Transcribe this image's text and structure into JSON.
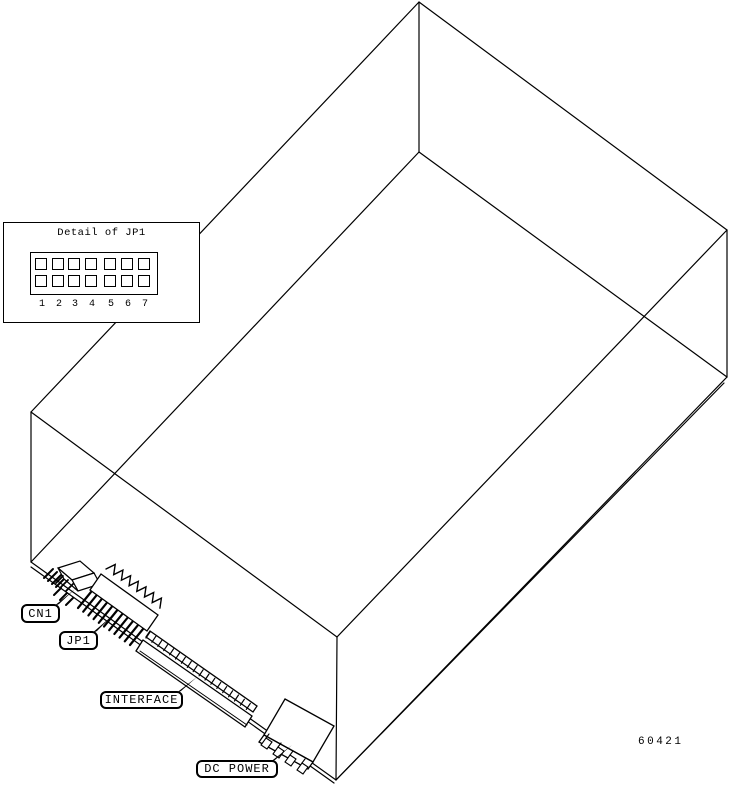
{
  "figure_number": "60421",
  "colors": {
    "line": "#000000",
    "background": "#ffffff"
  },
  "inset": {
    "title": "Detail of JP1",
    "pin_rows": 2,
    "pin_columns": 7,
    "pin_numbers": [
      "1",
      "2",
      "3",
      "4",
      "5",
      "6",
      "7"
    ]
  },
  "callouts": {
    "cn1": "CN1",
    "jp1": "JP1",
    "interface": "INTERFACE",
    "dc_power": "DC POWER"
  }
}
